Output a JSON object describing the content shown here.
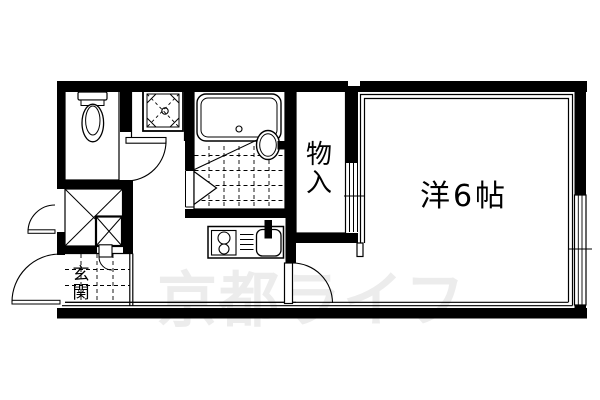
{
  "colors": {
    "background": "#ffffff",
    "ink": "#000000",
    "watermark": "#ececec"
  },
  "watermark": {
    "text": "京都ライフ"
  },
  "rooms": {
    "western_room": {
      "label": "洋6帖"
    },
    "closet": {
      "label": "物入"
    },
    "entrance": {
      "label": "玄関"
    }
  }
}
